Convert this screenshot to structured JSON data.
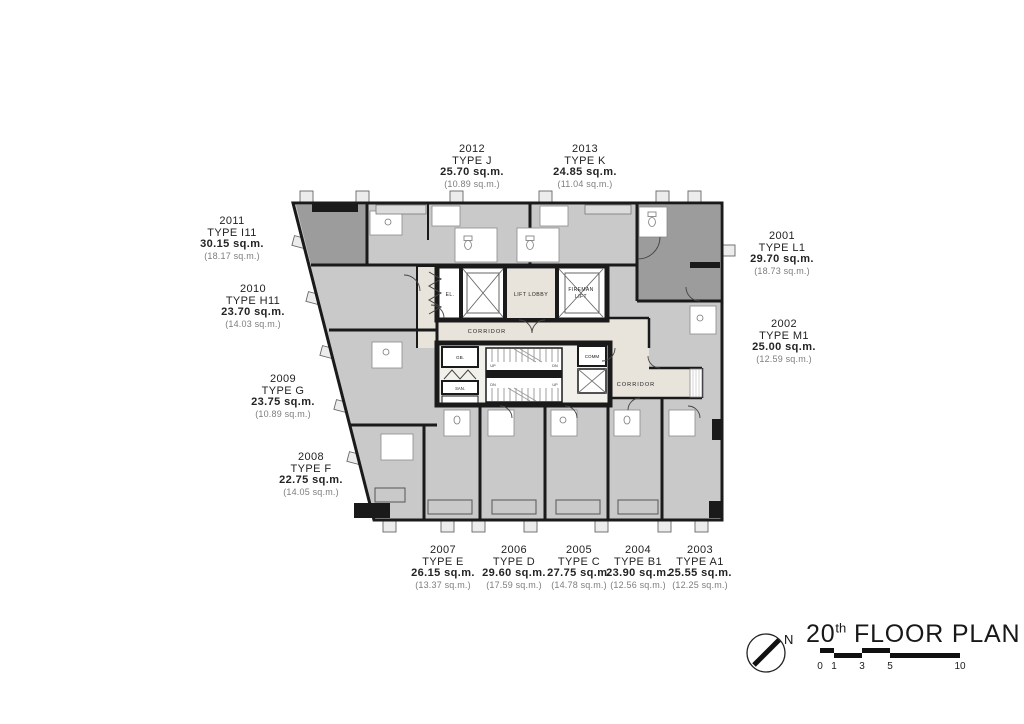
{
  "plan": {
    "title": {
      "floor_number": "20",
      "ordinal_suffix": "th",
      "text": " FLOOR PLAN"
    },
    "north_label": "N",
    "scale_bar": {
      "ticks": [
        "0",
        "1",
        "3",
        "5",
        "10"
      ]
    },
    "core": {
      "el": "EL.",
      "lift_lobby": "LIFT LOBBY",
      "fireman_lift_line1": "FIREMAN",
      "fireman_lift_line2": "LIFT",
      "corridor_main": "CORRIDOR",
      "corridor_right": "CORRIDOR",
      "gb": "GB.",
      "san": "SAN.",
      "comm": "COMM",
      "up": "UP",
      "dn": "DN"
    },
    "units": [
      {
        "number": "2001",
        "type": "TYPE L1",
        "area": "29.70 sq.m.",
        "area_secondary": "(18.73 sq.m.)"
      },
      {
        "number": "2002",
        "type": "TYPE M1",
        "area": "25.00 sq.m.",
        "area_secondary": "(12.59 sq.m.)"
      },
      {
        "number": "2003",
        "type": "TYPE A1",
        "area": "25.55 sq.m.",
        "area_secondary": "(12.25 sq.m.)"
      },
      {
        "number": "2004",
        "type": "TYPE B1",
        "area": "23.90 sq.m.",
        "area_secondary": "(12.56 sq.m.)"
      },
      {
        "number": "2005",
        "type": "TYPE C",
        "area": "27.75 sq.m.",
        "area_secondary": "(14.78 sq.m.)"
      },
      {
        "number": "2006",
        "type": "TYPE D",
        "area": "29.60 sq.m.",
        "area_secondary": "(17.59 sq.m.)"
      },
      {
        "number": "2007",
        "type": "TYPE E",
        "area": "26.15 sq.m.",
        "area_secondary": "(13.37 sq.m.)"
      },
      {
        "number": "2008",
        "type": "TYPE F",
        "area": "22.75 sq.m.",
        "area_secondary": "(14.05 sq.m.)"
      },
      {
        "number": "2009",
        "type": "TYPE G",
        "area": "23.75 sq.m.",
        "area_secondary": "(10.89 sq.m.)"
      },
      {
        "number": "2010",
        "type": "TYPE H11",
        "area": "23.70 sq.m.",
        "area_secondary": "(14.03 sq.m.)"
      },
      {
        "number": "2011",
        "type": "TYPE I11",
        "area": "30.15 sq.m.",
        "area_secondary": "(18.17 sq.m.)"
      },
      {
        "number": "2012",
        "type": "TYPE J",
        "area": "25.70 sq.m.",
        "area_secondary": "(10.89 sq.m.)"
      },
      {
        "number": "2013",
        "type": "TYPE K",
        "area": "24.85 sq.m.",
        "area_secondary": "(11.04 sq.m.)"
      }
    ]
  },
  "colors": {
    "wall": "#1a1a1a",
    "unit_light": "#c9c9c9",
    "unit_dark": "#9c9c9c",
    "corridor": "#e9e4db",
    "core_floor": "#f2f0ea"
  }
}
